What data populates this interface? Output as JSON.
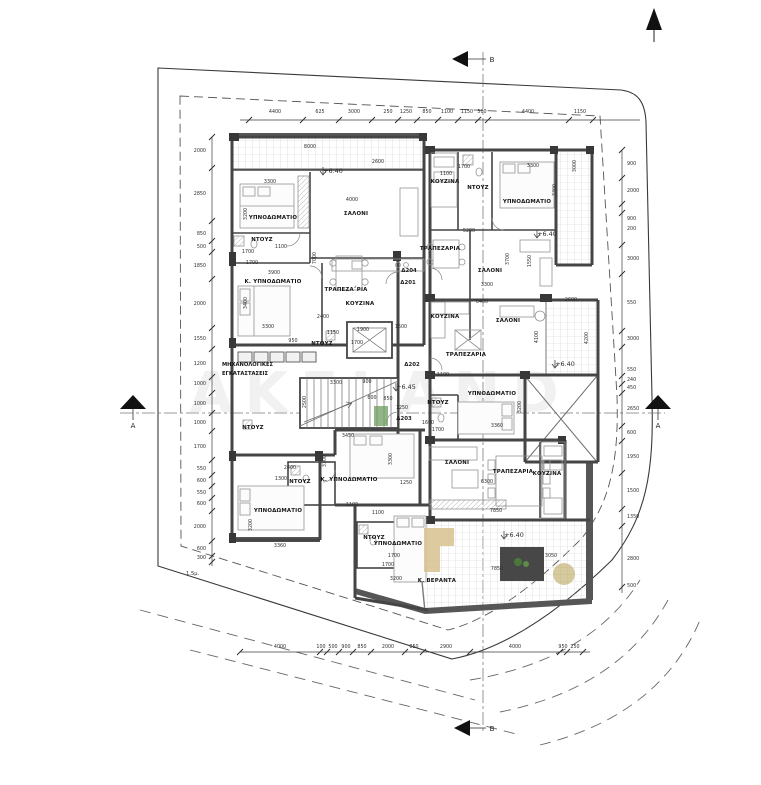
{
  "watermark": "AKELAND",
  "sections": {
    "a": "A",
    "b": "B"
  },
  "setback_label": "1.5μ.",
  "levels": [
    "+6.40",
    "+6.40",
    "+6.40",
    "+6.40",
    "+6.45"
  ],
  "door_tags": [
    "Δ204",
    "Δ201",
    "Δ202",
    "Δ203"
  ],
  "utility": [
    "ΜΗΧΑΝΟΛΟΓΙΚΕΣ",
    "ΕΓΚΑΤΑΣΤΑΣΕΙΣ"
  ],
  "rooms": [
    "ΥΠΝΟΔΩΜΑΤΙΟ",
    "ΝΤΟΥΖ",
    "Κ. ΥΠΝΟΔΩΜΑΤΙΟ",
    "ΝΤΟΥΖ",
    "ΣΑΛΟΝΙ",
    "ΤΡΑΠΕΖΑ΅ΡΙΑ",
    "ΚΟΥΖΙΝΑ",
    "ΚΟΥΖΙΝΑ",
    "ΝΤΟΥΖ",
    "ΥΠΝΟΔΩΜΑΤΙΟ",
    "ΤΡΑΠΕΖΑΡΙΑ",
    "ΣΑΛΟΝΙ",
    "ΚΟΥΖΙΝΑ",
    "ΣΑΛΟΝΙ",
    "ΤΡΑΠΕΖΑΡΙΑ",
    "ΥΠΝΟΔΩΜΑΤΙΟ",
    "ΝΤΟΥΖ",
    "Κ. ΥΠΝΟΔΩΜΑΤΙΟ",
    "ΥΠΝΟΔΩΜΑΤΙΟ",
    "ΝΤΟΥΖ",
    "ΝΤΟΥΖ",
    "ΥΠΝΟΔΩΜΑΤΙΟ",
    "ΝΤΟΥΖ",
    "ΣΑΛΟΝΙ",
    "ΤΡΑΠΕΖΑΡΙΑ",
    "ΚΟΥΖΙΝΑ",
    "Κ. ΒΕΡΑΝΤΑ"
  ],
  "dims": {
    "top": [
      "4400",
      "625",
      "3000",
      "250",
      "1250",
      "850",
      "1100",
      "1150",
      "500",
      "4400",
      "1150"
    ],
    "left": [
      "2000",
      "2850",
      "850",
      "500",
      "1850",
      "2000",
      "1550",
      "1200",
      "1000",
      "1000",
      "1000",
      "1700",
      "550",
      "600",
      "550",
      "600",
      "2000",
      "600",
      "300"
    ],
    "right": [
      "900",
      "2000",
      "900",
      "200",
      "3000",
      "550",
      "3000",
      "550",
      "240",
      "450",
      "2650",
      "600",
      "1950",
      "1500",
      "1350",
      "2800",
      "500"
    ],
    "bottom": [
      "4000",
      "100",
      "500",
      "900",
      "850",
      "2000",
      "850",
      "2900",
      "4000",
      "950",
      "250"
    ],
    "inner": [
      "8000",
      "2600",
      "3300",
      "3200",
      "1700",
      "1100",
      "1700",
      "3900",
      "3400",
      "3300",
      "950",
      "1150",
      "4000",
      "7000",
      "2400",
      "1900",
      "1700",
      "1500",
      "5200",
      "1100",
      "1700",
      "3300",
      "3300",
      "3000",
      "3700",
      "1550",
      "3300",
      "6400",
      "2600",
      "4100",
      "4200",
      "1100",
      "3200",
      "3360",
      "1600",
      "1700",
      "2500",
      "3300",
      "900",
      "600",
      "850",
      "1250",
      "3450",
      "3300",
      "3300",
      "3200",
      "3360",
      "2400",
      "1300",
      "1250",
      "1100",
      "1100",
      "1700",
      "1700",
      "3200",
      "6300",
      "7850",
      "3050",
      "7850"
    ]
  }
}
